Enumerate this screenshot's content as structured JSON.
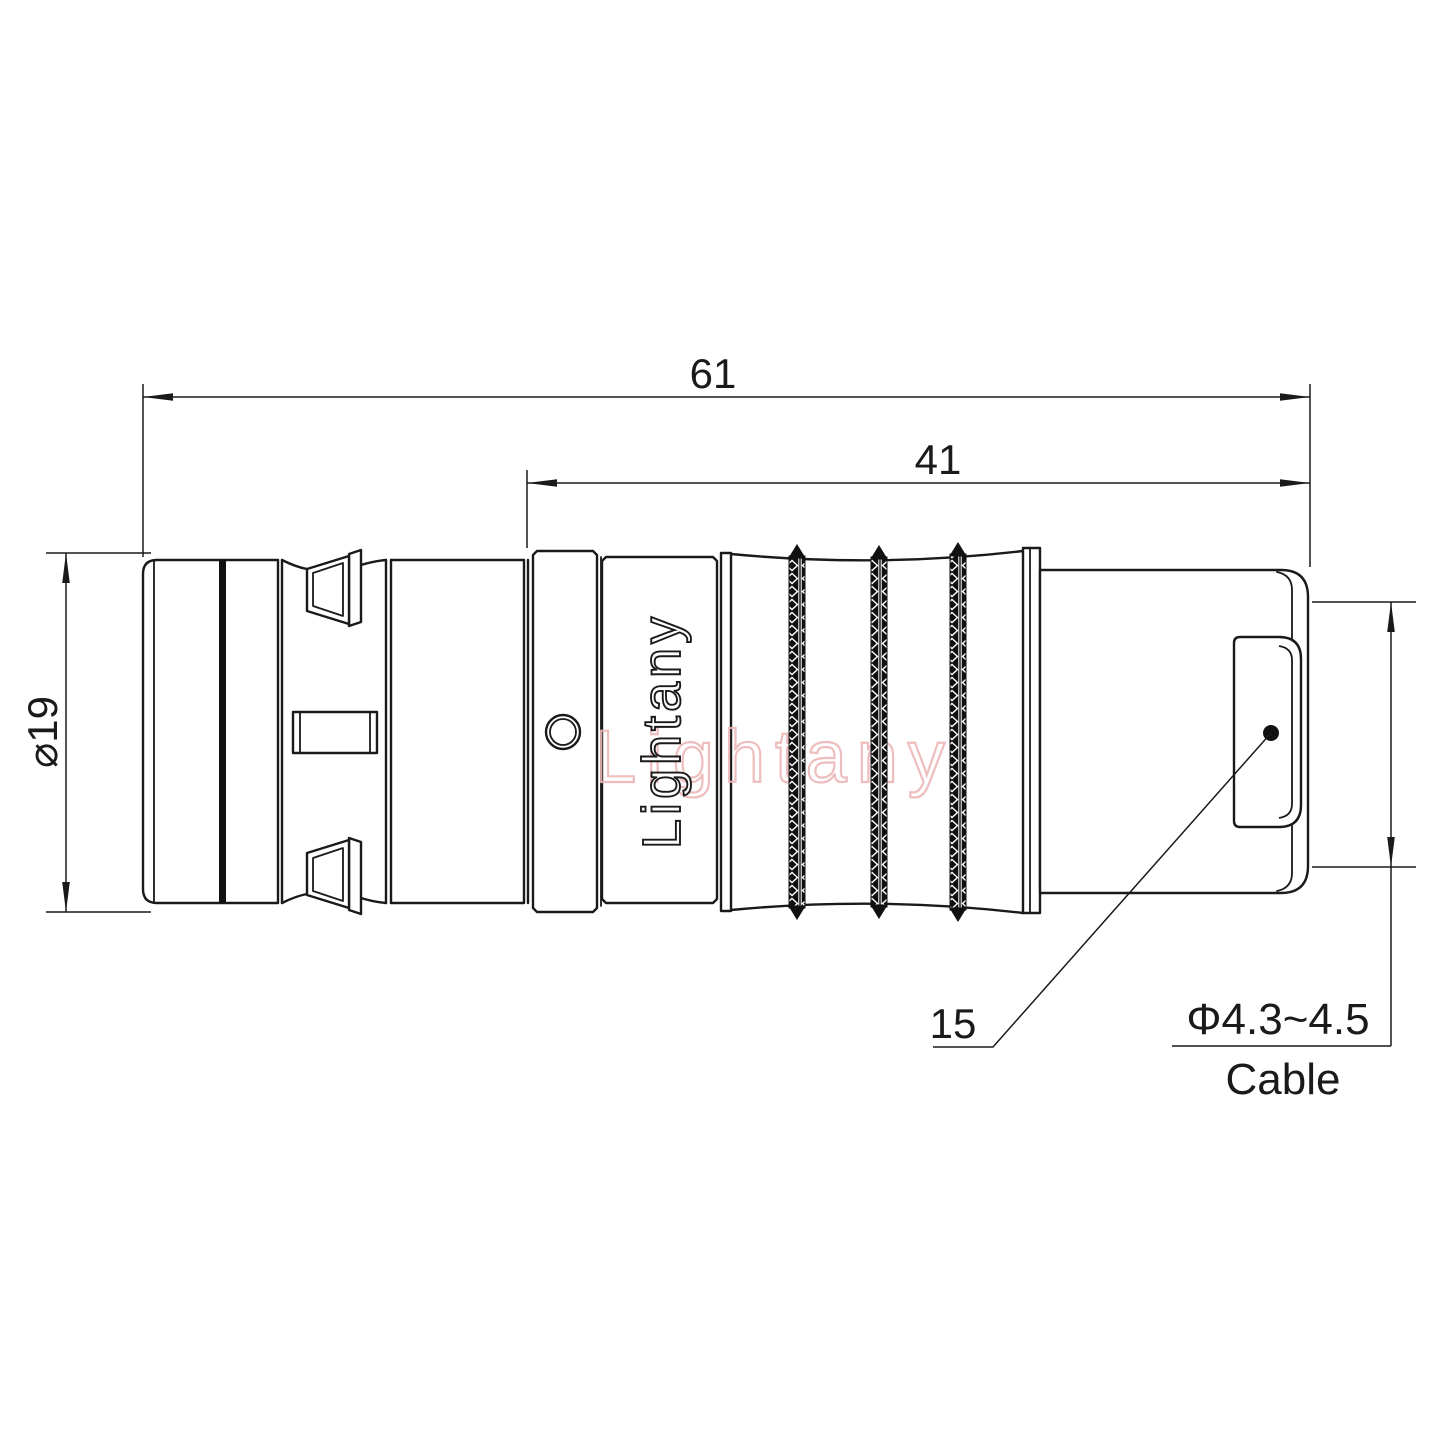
{
  "drawing": {
    "brand": "Lightany",
    "watermark": "Lightany",
    "dimensions": {
      "overall_length": "61",
      "front_section_length": "41",
      "outer_diameter": "⌀19",
      "rear_section_length": "15",
      "cable_diameter": "Φ4.3~4.5",
      "cable_label": "Cable"
    },
    "colors": {
      "line": "#1a1a1a",
      "watermark": "#edb7b7",
      "background": "#ffffff"
    }
  }
}
